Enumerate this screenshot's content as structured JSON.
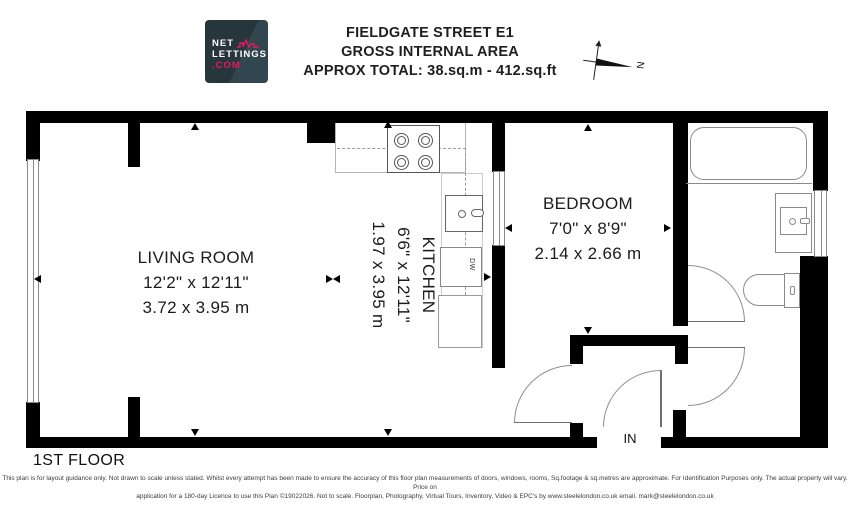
{
  "header": {
    "logo": {
      "line1": "NET",
      "line2": "LETTINGS",
      "line3": ".COM"
    },
    "title_line1": "FIELDGATE STREET E1",
    "title_line2": "GROSS INTERNAL AREA",
    "title_line3": "APPROX TOTAL: 38.sq.m - 412.sq.ft",
    "compass_label": "N"
  },
  "rooms": {
    "living": {
      "name": "LIVING ROOM",
      "imperial": "12'2\" x 12'11\"",
      "metric": "3.72 x 3.95 m"
    },
    "kitchen": {
      "name": "KITCHEN",
      "imperial": "6'6\" x 12'11\"",
      "metric": "1.97 x 3.95 m"
    },
    "bedroom": {
      "name": "BEDROOM",
      "imperial": "7'0\" x 8'9\"",
      "metric": "2.14 x 2.66 m"
    }
  },
  "labels": {
    "dishwasher": "DW",
    "entry": "IN",
    "floor": "1ST FLOOR"
  },
  "footer": {
    "line1": "This plan is for layout guidance only. Not drawn to scale unless stated. Whilst every attempt has been made to ensure the accuracy of this floor plan measurements of doors, windows, rooms, Sq.footage & sq.metres are approximate. For Identification Purposes only. The actual property will vary. Price on",
    "line2": "application for a 180-day Licence to use this Plan ©19022026. Not to scale. Floorplan, Photography, Virtual Tours, Inventory, Video & EPC's by www.steelelondon.co.uk email. mark@steelelondon.co.uk"
  },
  "colors": {
    "wall": "#000000",
    "fixture_outline": "#8a8a8a",
    "logo_background": "#27353d",
    "logo_accent": "#e8175d"
  }
}
